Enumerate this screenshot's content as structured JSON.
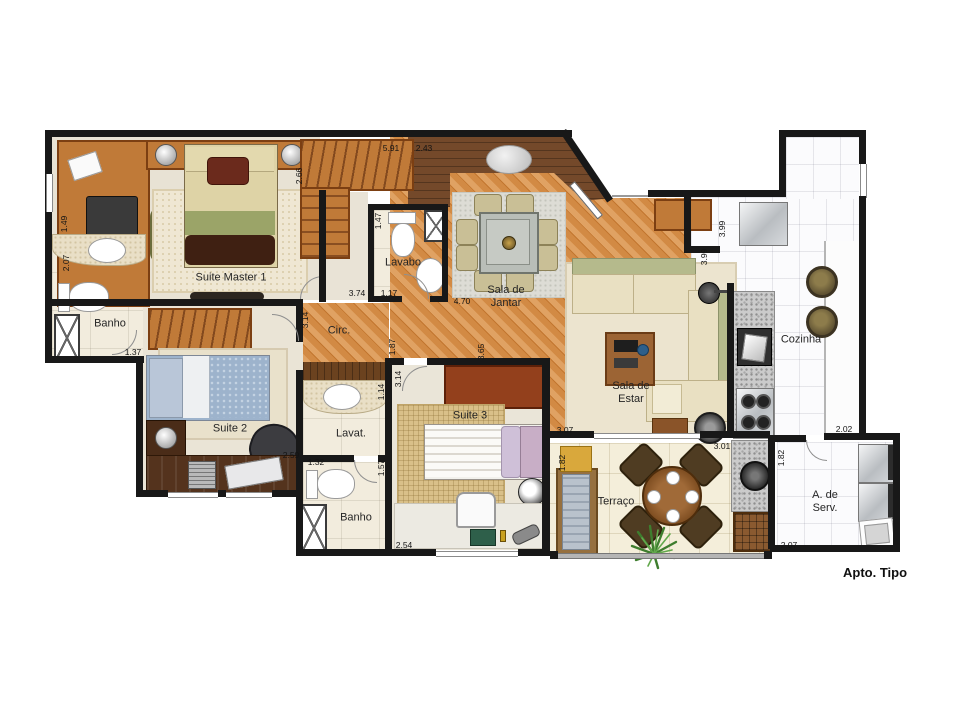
{
  "palette": {
    "wall": "#181818",
    "wood_floor": "#d28a44",
    "entry_wood": "#74492a",
    "furniture_wood": "#c07a38",
    "dark_desk": "#54331d",
    "tile_cream": "#f2ecdd",
    "tile_white": "#fbfbfd",
    "granite": "#cbcbcb",
    "sofa_cream": "#e9e0c2",
    "sofa_olive": "#b5ba8c",
    "bed_blue": "#9db3cc",
    "bed_pink": "#c8aec6",
    "lounger_yellow": "#d9a83c",
    "plant_green": "#4a8a3a"
  },
  "rooms": {
    "suite_master1": "Suite Master 1",
    "banho_1": "Banho",
    "suite_2": "Suite 2",
    "circ": "Circ.",
    "lavabo": "Lavabo",
    "sala_de_jantar": [
      "Sala de",
      "Jantar"
    ],
    "sala_de_estar": [
      "Sala de",
      "Estar"
    ],
    "cozinha": "Cozinha",
    "lavat": "Lavat.",
    "suite_3": "Suite 3",
    "banho_2": "Banho",
    "terraco": "Terraço",
    "area_servico": [
      "A. de",
      "Serv."
    ]
  },
  "dimensions": {
    "suite_master_left": "1.49",
    "banho1_left": "2.07",
    "banho1_bottom": "1.37",
    "suite_master_right": "2.66",
    "entry_top_a": "5.91",
    "entry_top_b": "2.43",
    "lavabo_left": "1.47",
    "suite_master_bottom": "3.74",
    "lavabo_bottom": "1.17",
    "jantar_bottom": "4.70",
    "circ_right": "3.14",
    "circ_left": "1.87",
    "suite3_left": "3.14",
    "estar_left": "3.65",
    "cozinha_wall_a": "3.99",
    "cozinha_wall_b": "3.99",
    "suite2_bottom": "2.59",
    "banho2_top": "1.32",
    "banho2_right": "1.57",
    "lavat_right": "1.14",
    "estar_bottom": "3.07",
    "suite3_bottom": "2.54",
    "terraco_top": "3.01",
    "terraco_left": "1.82",
    "aserv_left": "1.82",
    "aserv_top": "2.02",
    "aserv_bottom": "2.07"
  },
  "footer": {
    "plan_label": "Apto. Tipo"
  }
}
